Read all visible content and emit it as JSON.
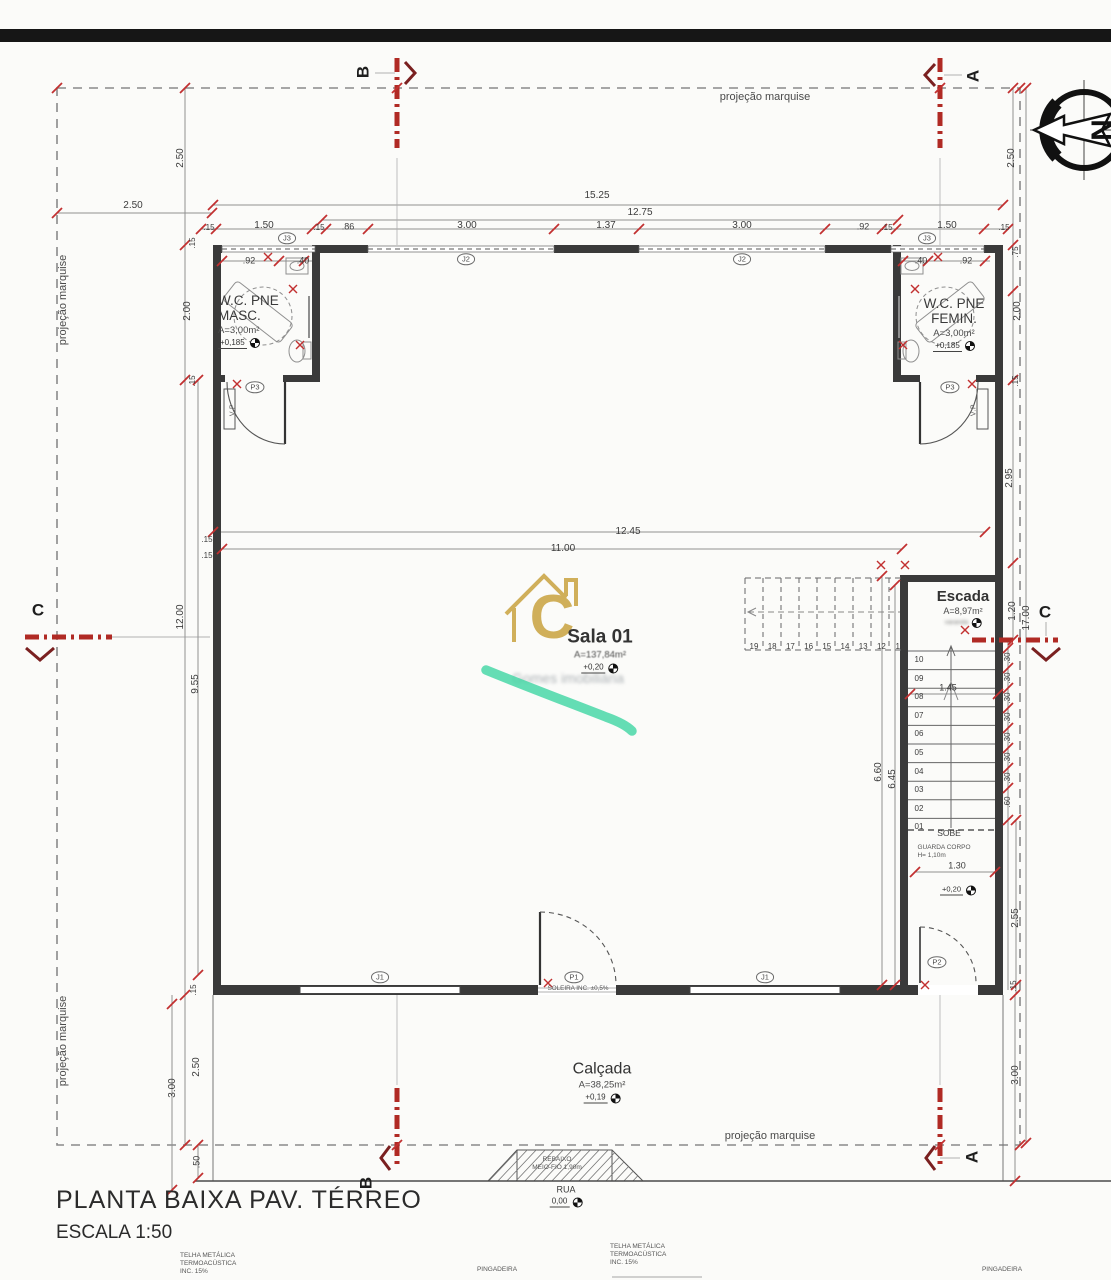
{
  "title_block": {
    "title": "PLANTA BAIXA PAV. TÉRREO",
    "scale": "ESCALA 1:50"
  },
  "annotations": {
    "marquise": "projeção marquise",
    "soleira": "SOLEIRA INC. ±0,5%",
    "rebaixo_line1": "REBAIXO",
    "rebaixo_line2": "MEIO-FIO 1,90m",
    "telha_line1": "TELHA METÁLICA",
    "telha_line2": "TERMOACÚSTICA",
    "telha_line3": "INC. 15%",
    "pingadeira": "PINGADEIRA",
    "sobe": "SOBE",
    "guarda_corpo_line1": "GUARDA CORPO",
    "guarda_corpo_line2": "H= 1,10m",
    "varanda": "varanda"
  },
  "rooms": {
    "wc_masc": {
      "line1": "W.C. PNE",
      "line2": "MASC.",
      "area": "A=3,00m²",
      "level": "+0,185"
    },
    "wc_fem": {
      "line1": "W.C. PNE",
      "line2": "FEMIN.",
      "area": "A=3,00m²",
      "level": "+0,185"
    },
    "sala": {
      "name": "Sala 01",
      "area": "A=137,84m²",
      "level": "+0,20"
    },
    "escada": {
      "name": "Escada",
      "area": "A=8,97m²"
    },
    "varanda_level": "+0,20",
    "calcada": {
      "name": "Calçada",
      "area": "A=38,25m²",
      "level": "+0,19"
    },
    "rua": {
      "name": "RUA",
      "level": "0,00"
    }
  },
  "stairs": {
    "upper_steps": [
      "19",
      "18",
      "17",
      "16",
      "15",
      "14",
      "13",
      "12",
      "11"
    ],
    "lower_steps": [
      "10",
      "09",
      "08",
      "07",
      "06",
      "05",
      "04",
      "03",
      "02",
      "01"
    ]
  },
  "section_markers": {
    "b_top": "B",
    "a_top": "A",
    "c_left": "C",
    "c_right": "C",
    "b_bottom": "B",
    "a_bottom": "A"
  },
  "openings_tags": [
    {
      "t": "J3",
      "x": 287,
      "y": 238
    },
    {
      "t": "J2",
      "x": 466,
      "y": 259
    },
    {
      "t": "J2",
      "x": 742,
      "y": 259
    },
    {
      "t": "J3",
      "x": 927,
      "y": 238
    },
    {
      "t": "P3",
      "x": 255,
      "y": 387
    },
    {
      "t": "P3",
      "x": 950,
      "y": 387
    },
    {
      "t": "J1",
      "x": 380,
      "y": 977
    },
    {
      "t": "P1",
      "x": 574,
      "y": 977
    },
    {
      "t": "J1",
      "x": 765,
      "y": 977
    },
    {
      "t": "P2",
      "x": 937,
      "y": 962
    },
    {
      "t": "V.P",
      "x": 233,
      "y": 410,
      "r": -90
    },
    {
      "t": "V.P",
      "x": 974,
      "y": 410,
      "r": -90
    }
  ],
  "dimensions": [
    {
      "t": "2.50",
      "x": 133,
      "y": 206
    },
    {
      "t": "15.25",
      "x": 597,
      "y": 196
    },
    {
      "t": "12.75",
      "x": 640,
      "y": 213
    },
    {
      "t": ".15",
      "x": 209,
      "y": 228,
      "s": 8
    },
    {
      "t": "1.50",
      "x": 264,
      "y": 226
    },
    {
      "t": ".15",
      "x": 319,
      "y": 228,
      "s": 8
    },
    {
      "t": ".86",
      "x": 348,
      "y": 227,
      "s": 9
    },
    {
      "t": "3.00",
      "x": 467,
      "y": 226
    },
    {
      "t": "1.37",
      "x": 606,
      "y": 226
    },
    {
      "t": "3.00",
      "x": 742,
      "y": 226
    },
    {
      "t": ".92",
      "x": 863,
      "y": 227,
      "s": 9
    },
    {
      "t": ".15",
      "x": 887,
      "y": 228,
      "s": 8
    },
    {
      "t": "1.50",
      "x": 947,
      "y": 226
    },
    {
      "t": ".15",
      "x": 1004,
      "y": 228,
      "s": 8
    },
    {
      "t": ".92",
      "x": 249,
      "y": 261,
      "s": 9
    },
    {
      "t": ".40",
      "x": 303,
      "y": 261,
      "s": 9
    },
    {
      "t": ".40",
      "x": 921,
      "y": 261,
      "s": 9
    },
    {
      "t": ".92",
      "x": 966,
      "y": 261,
      "s": 9
    },
    {
      "t": "2.50",
      "x": 181,
      "y": 158,
      "r": -90
    },
    {
      "t": "2.50",
      "x": 1012,
      "y": 158,
      "r": -90
    },
    {
      "t": "2.00",
      "x": 188,
      "y": 311,
      "r": -90
    },
    {
      "t": "2.00",
      "x": 1018,
      "y": 311,
      "r": -90
    },
    {
      "t": ".15",
      "x": 193,
      "y": 243,
      "r": -90,
      "s": 8
    },
    {
      "t": ".15",
      "x": 193,
      "y": 381,
      "r": -90,
      "s": 8
    },
    {
      "t": ".75",
      "x": 1016,
      "y": 252,
      "r": -90,
      "s": 8
    },
    {
      "t": ".15",
      "x": 1016,
      "y": 381,
      "r": -90,
      "s": 8
    },
    {
      "t": "12.00",
      "x": 181,
      "y": 617,
      "r": -90
    },
    {
      "t": "9.55",
      "x": 196,
      "y": 684,
      "r": -90
    },
    {
      "t": "2.95",
      "x": 1010,
      "y": 478,
      "r": -90
    },
    {
      "t": "1.20",
      "x": 1013,
      "y": 611,
      "r": -90
    },
    {
      "t": "17.00",
      "x": 1027,
      "y": 618,
      "r": -90
    },
    {
      "t": "12.45",
      "x": 628,
      "y": 532
    },
    {
      "t": "11.00",
      "x": 563,
      "y": 549
    },
    {
      "t": ".15",
      "x": 207,
      "y": 540,
      "s": 8
    },
    {
      "t": ".15",
      "x": 207,
      "y": 556,
      "s": 8
    },
    {
      "t": "6.60",
      "x": 879,
      "y": 772,
      "r": -90
    },
    {
      "t": "6.45",
      "x": 893,
      "y": 779,
      "r": -90
    },
    {
      "t": "1.45",
      "x": 948,
      "y": 688,
      "s": 9
    },
    {
      "t": ".30",
      "x": 1008,
      "y": 658,
      "r": -90,
      "s": 8
    },
    {
      "t": ".30",
      "x": 1008,
      "y": 678,
      "r": -90,
      "s": 8
    },
    {
      "t": ".30",
      "x": 1008,
      "y": 698,
      "r": -90,
      "s": 8
    },
    {
      "t": ".30",
      "x": 1008,
      "y": 718,
      "r": -90,
      "s": 8
    },
    {
      "t": ".30",
      "x": 1008,
      "y": 738,
      "r": -90,
      "s": 8
    },
    {
      "t": ".30",
      "x": 1008,
      "y": 758,
      "r": -90,
      "s": 8
    },
    {
      "t": ".30",
      "x": 1008,
      "y": 778,
      "r": -90,
      "s": 8
    },
    {
      "t": ".60",
      "x": 1008,
      "y": 802,
      "r": -90,
      "s": 8
    },
    {
      "t": "1.30",
      "x": 957,
      "y": 866,
      "s": 9
    },
    {
      "t": "2.55",
      "x": 1016,
      "y": 918,
      "r": -90
    },
    {
      "t": ".15",
      "x": 1014,
      "y": 986,
      "r": -90,
      "s": 8
    },
    {
      "t": "3.00",
      "x": 1016,
      "y": 1075,
      "r": -90
    },
    {
      "t": "2.50",
      "x": 197,
      "y": 1067,
      "r": -90
    },
    {
      "t": "3.00",
      "x": 173,
      "y": 1088,
      "r": -90
    },
    {
      "t": ".50",
      "x": 197,
      "y": 1162,
      "r": -90,
      "s": 9
    },
    {
      "t": ".15",
      "x": 194,
      "y": 990,
      "r": -90,
      "s": 8
    }
  ],
  "watermark": {
    "letter": "C",
    "text": "Gomes imobiliária"
  },
  "compass": {
    "letter": "N"
  },
  "colors": {
    "section_red": "#b02a24",
    "tick_red": "#c23030",
    "highlight_green": "#3fd6a2",
    "watermark_gold": "#c9a23f"
  }
}
